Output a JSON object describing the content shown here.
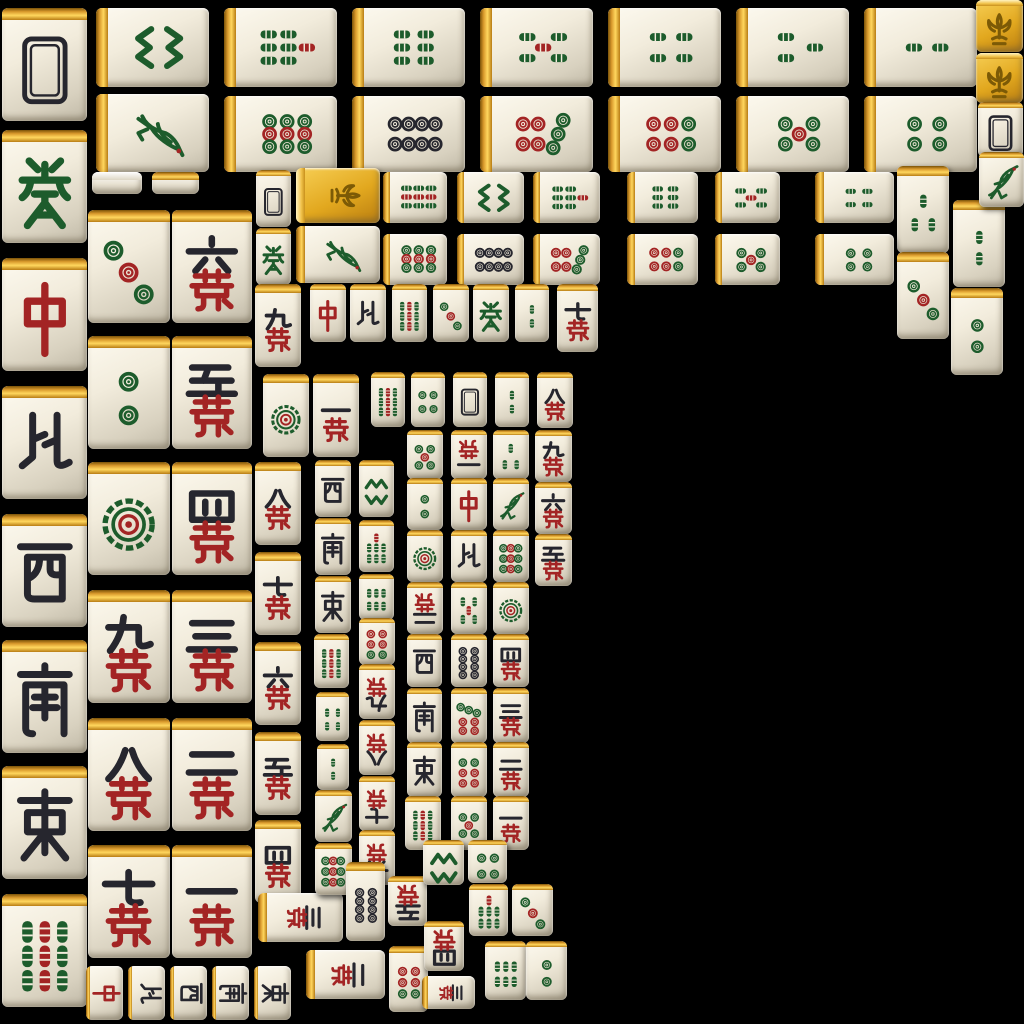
{
  "scene": {
    "title": "Mahjong tile sprite atlas",
    "background_color": "#000000",
    "canvas": {
      "width": 1024,
      "height": 1024
    }
  },
  "palette": {
    "tile_face": "#f2ecdc",
    "tile_shade": "#bfb8a6",
    "gold_edge": "#e2a81f",
    "glyph_black": "#26262e",
    "glyph_red": "#a32424",
    "glyph_green": "#1d5c2c",
    "flower_gold": "#e2a81f",
    "flower_glyph": "#7c5a06"
  },
  "legend": {
    "suits": {
      "bamboo": "Bamboo (sticks, rank 1 is the sparrow bird)",
      "circle": "Circles (dots)",
      "char": "Characters — numeral over red wan (10k)",
      "wind": "Winds: E=East(dong) S=South(nan) W=West(xi) N=North(bei)",
      "dragon": "Dragons: red=zhong, green=fa",
      "back": "Blank tile back / White Dragon frame",
      "flower": "Gold flower (fleur-de-lis) tile",
      "side": "Tile side sprite strip"
    },
    "rotations": {
      "0": "upright",
      "90": "rotated sideways",
      "180": "inverted (opponent view)"
    }
  },
  "tiles": [
    [
      2,
      8,
      85,
      113,
      0,
      "back",
      ""
    ],
    [
      2,
      130,
      85,
      113,
      0,
      "dragon",
      "green"
    ],
    [
      2,
      258,
      85,
      113,
      0,
      "dragon",
      "red"
    ],
    [
      2,
      386,
      85,
      113,
      0,
      "wind",
      "N"
    ],
    [
      2,
      514,
      85,
      113,
      0,
      "wind",
      "W"
    ],
    [
      2,
      640,
      85,
      113,
      0,
      "wind",
      "S"
    ],
    [
      2,
      766,
      85,
      113,
      0,
      "wind",
      "E"
    ],
    [
      2,
      894,
      85,
      113,
      0,
      "bamboo",
      9
    ],
    [
      88,
      210,
      82,
      113,
      0,
      "circle",
      3
    ],
    [
      88,
      336,
      82,
      113,
      0,
      "circle",
      2
    ],
    [
      88,
      462,
      82,
      113,
      0,
      "circle",
      1
    ],
    [
      88,
      590,
      82,
      113,
      0,
      "char",
      9
    ],
    [
      88,
      718,
      82,
      113,
      0,
      "char",
      8
    ],
    [
      88,
      845,
      82,
      113,
      0,
      "char",
      7
    ],
    [
      172,
      210,
      80,
      113,
      0,
      "char",
      6
    ],
    [
      172,
      336,
      80,
      113,
      0,
      "char",
      5
    ],
    [
      172,
      462,
      80,
      113,
      0,
      "char",
      4
    ],
    [
      172,
      590,
      80,
      113,
      0,
      "char",
      3
    ],
    [
      172,
      718,
      80,
      113,
      0,
      "char",
      2
    ],
    [
      172,
      845,
      80,
      113,
      0,
      "char",
      1
    ],
    [
      96,
      8,
      113,
      79,
      90,
      "bamboo",
      8
    ],
    [
      224,
      8,
      113,
      79,
      90,
      "bamboo",
      7
    ],
    [
      352,
      8,
      113,
      79,
      90,
      "bamboo",
      6
    ],
    [
      480,
      8,
      113,
      79,
      90,
      "bamboo",
      5
    ],
    [
      608,
      8,
      113,
      79,
      90,
      "bamboo",
      4
    ],
    [
      736,
      8,
      113,
      79,
      90,
      "bamboo",
      3
    ],
    [
      864,
      8,
      113,
      79,
      90,
      "bamboo",
      2
    ],
    [
      96,
      94,
      113,
      78,
      90,
      "bamboo",
      1
    ],
    [
      224,
      96,
      113,
      76,
      90,
      "circle",
      9
    ],
    [
      352,
      96,
      113,
      76,
      90,
      "circle",
      8
    ],
    [
      480,
      96,
      113,
      76,
      90,
      "circle",
      7
    ],
    [
      608,
      96,
      113,
      76,
      90,
      "circle",
      6
    ],
    [
      736,
      96,
      113,
      76,
      90,
      "circle",
      5
    ],
    [
      864,
      96,
      113,
      76,
      90,
      "circle",
      4
    ],
    [
      92,
      172,
      50,
      22,
      0,
      "side",
      ""
    ],
    [
      152,
      172,
      47,
      22,
      0,
      "side",
      "gold"
    ],
    [
      256,
      170,
      35,
      57,
      0,
      "back",
      ""
    ],
    [
      296,
      168,
      84,
      55,
      90,
      "flower",
      ""
    ],
    [
      383,
      172,
      64,
      51,
      90,
      "bamboo",
      9
    ],
    [
      457,
      172,
      67,
      51,
      90,
      "bamboo",
      8
    ],
    [
      533,
      172,
      67,
      51,
      90,
      "bamboo",
      7
    ],
    [
      627,
      172,
      71,
      51,
      90,
      "bamboo",
      6
    ],
    [
      715,
      172,
      65,
      51,
      90,
      "bamboo",
      5
    ],
    [
      815,
      172,
      79,
      51,
      90,
      "bamboo",
      4
    ],
    [
      897,
      166,
      52,
      87,
      0,
      "bamboo",
      3
    ],
    [
      256,
      228,
      35,
      57,
      0,
      "dragon",
      "green"
    ],
    [
      296,
      226,
      84,
      57,
      90,
      "bamboo",
      1
    ],
    [
      383,
      234,
      64,
      51,
      90,
      "circle",
      9
    ],
    [
      457,
      234,
      67,
      51,
      90,
      "circle",
      8
    ],
    [
      533,
      234,
      67,
      51,
      90,
      "circle",
      7
    ],
    [
      627,
      234,
      71,
      51,
      90,
      "circle",
      6
    ],
    [
      715,
      234,
      65,
      51,
      90,
      "circle",
      5
    ],
    [
      815,
      234,
      79,
      51,
      90,
      "circle",
      4
    ],
    [
      897,
      252,
      52,
      87,
      0,
      "circle",
      3
    ],
    [
      953,
      200,
      52,
      87,
      0,
      "bamboo",
      2
    ],
    [
      951,
      288,
      52,
      87,
      0,
      "circle",
      2
    ],
    [
      976,
      0,
      47,
      52,
      0,
      "flower",
      ""
    ],
    [
      976,
      53,
      47,
      50,
      0,
      "flower",
      ""
    ],
    [
      978,
      102,
      45,
      55,
      0,
      "back",
      ""
    ],
    [
      979,
      152,
      45,
      55,
      0,
      "bamboo",
      1
    ],
    [
      255,
      284,
      46,
      83,
      0,
      "char",
      9
    ],
    [
      310,
      284,
      36,
      58,
      0,
      "dragon",
      "red"
    ],
    [
      350,
      284,
      36,
      58,
      0,
      "wind",
      "N"
    ],
    [
      392,
      284,
      35,
      58,
      0,
      "bamboo",
      9
    ],
    [
      433,
      284,
      36,
      58,
      0,
      "circle",
      3
    ],
    [
      473,
      284,
      36,
      58,
      0,
      "dragon",
      "green"
    ],
    [
      515,
      284,
      34,
      58,
      0,
      "bamboo",
      2
    ],
    [
      557,
      284,
      41,
      68,
      0,
      "char",
      7
    ],
    [
      263,
      374,
      46,
      83,
      0,
      "circle",
      1
    ],
    [
      313,
      374,
      46,
      83,
      0,
      "char",
      1
    ],
    [
      255,
      462,
      46,
      83,
      0,
      "char",
      8
    ],
    [
      255,
      552,
      46,
      83,
      0,
      "char",
      7
    ],
    [
      255,
      642,
      46,
      83,
      0,
      "char",
      6
    ],
    [
      255,
      732,
      46,
      83,
      0,
      "char",
      5
    ],
    [
      255,
      820,
      46,
      83,
      0,
      "char",
      4
    ],
    [
      258,
      893,
      85,
      49,
      90,
      "char",
      3
    ],
    [
      306,
      950,
      79,
      49,
      90,
      "char",
      2
    ],
    [
      315,
      460,
      36,
      57,
      0,
      "wind",
      "W"
    ],
    [
      315,
      518,
      36,
      57,
      0,
      "wind",
      "S"
    ],
    [
      315,
      576,
      36,
      57,
      0,
      "wind",
      "E"
    ],
    [
      314,
      634,
      35,
      54,
      0,
      "bamboo",
      9
    ],
    [
      316,
      692,
      33,
      49,
      0,
      "bamboo",
      4
    ],
    [
      317,
      744,
      32,
      46,
      0,
      "bamboo",
      2
    ],
    [
      315,
      790,
      37,
      52,
      0,
      "bamboo",
      1
    ],
    [
      315,
      843,
      37,
      52,
      0,
      "circle",
      9
    ],
    [
      359,
      460,
      35,
      57,
      0,
      "bamboo",
      8
    ],
    [
      359,
      520,
      35,
      52,
      0,
      "bamboo",
      7
    ],
    [
      359,
      574,
      35,
      46,
      0,
      "bamboo",
      6
    ],
    [
      359,
      618,
      36,
      47,
      180,
      "circle",
      6
    ],
    [
      359,
      664,
      36,
      55,
      180,
      "char",
      9
    ],
    [
      359,
      720,
      36,
      55,
      180,
      "char",
      8
    ],
    [
      359,
      776,
      36,
      55,
      180,
      "char",
      7
    ],
    [
      359,
      830,
      36,
      55,
      180,
      "char",
      6
    ],
    [
      371,
      372,
      34,
      55,
      0,
      "bamboo",
      9
    ],
    [
      411,
      372,
      34,
      55,
      0,
      "circle",
      4
    ],
    [
      453,
      372,
      34,
      55,
      0,
      "back",
      ""
    ],
    [
      495,
      372,
      34,
      55,
      0,
      "bamboo",
      2
    ],
    [
      537,
      372,
      36,
      56,
      0,
      "char",
      8
    ],
    [
      407,
      430,
      36,
      49,
      0,
      "circle",
      5
    ],
    [
      451,
      430,
      36,
      49,
      180,
      "char",
      1
    ],
    [
      493,
      430,
      36,
      49,
      0,
      "bamboo",
      3
    ],
    [
      535,
      430,
      37,
      52,
      0,
      "char",
      9
    ],
    [
      407,
      478,
      36,
      52,
      0,
      "circle",
      2
    ],
    [
      451,
      478,
      36,
      52,
      0,
      "dragon",
      "red"
    ],
    [
      493,
      478,
      36,
      52,
      0,
      "bamboo",
      1
    ],
    [
      535,
      482,
      37,
      52,
      0,
      "char",
      6
    ],
    [
      407,
      530,
      36,
      52,
      0,
      "circle",
      1
    ],
    [
      451,
      530,
      36,
      52,
      0,
      "wind",
      "N"
    ],
    [
      493,
      530,
      36,
      52,
      0,
      "circle",
      9
    ],
    [
      535,
      534,
      37,
      52,
      0,
      "char",
      5
    ],
    [
      407,
      582,
      36,
      52,
      180,
      "char",
      2
    ],
    [
      451,
      582,
      36,
      52,
      0,
      "bamboo",
      5
    ],
    [
      493,
      582,
      36,
      52,
      0,
      "circle",
      1
    ],
    [
      407,
      634,
      35,
      53,
      0,
      "wind",
      "W"
    ],
    [
      451,
      634,
      36,
      53,
      0,
      "circle",
      8
    ],
    [
      493,
      634,
      36,
      53,
      0,
      "char",
      4
    ],
    [
      407,
      688,
      35,
      55,
      0,
      "wind",
      "S"
    ],
    [
      451,
      688,
      36,
      55,
      0,
      "circle",
      7
    ],
    [
      493,
      688,
      36,
      55,
      0,
      "char",
      3
    ],
    [
      407,
      742,
      35,
      55,
      0,
      "wind",
      "E"
    ],
    [
      451,
      742,
      36,
      55,
      0,
      "circle",
      6
    ],
    [
      493,
      742,
      36,
      55,
      0,
      "char",
      2
    ],
    [
      405,
      796,
      36,
      54,
      0,
      "bamboo",
      9
    ],
    [
      451,
      796,
      36,
      54,
      0,
      "circle",
      5
    ],
    [
      493,
      796,
      36,
      54,
      0,
      "char",
      1
    ],
    [
      346,
      862,
      39,
      79,
      0,
      "circle",
      8
    ],
    [
      388,
      876,
      39,
      50,
      180,
      "char",
      5
    ],
    [
      389,
      946,
      39,
      66,
      180,
      "circle",
      6
    ],
    [
      424,
      921,
      40,
      50,
      180,
      "char",
      4
    ],
    [
      423,
      840,
      41,
      45,
      0,
      "bamboo",
      8
    ],
    [
      468,
      840,
      39,
      43,
      0,
      "circle",
      4
    ],
    [
      469,
      884,
      39,
      52,
      0,
      "bamboo",
      7
    ],
    [
      512,
      884,
      41,
      52,
      0,
      "circle",
      3
    ],
    [
      422,
      976,
      53,
      33,
      90,
      "char",
      3
    ],
    [
      485,
      941,
      41,
      59,
      0,
      "bamboo",
      6
    ],
    [
      526,
      941,
      41,
      59,
      0,
      "circle",
      2
    ],
    [
      86,
      966,
      37,
      54,
      90,
      "dragon",
      "red"
    ],
    [
      128,
      966,
      37,
      54,
      90,
      "wind",
      "N"
    ],
    [
      170,
      966,
      37,
      54,
      90,
      "wind",
      "W"
    ],
    [
      212,
      966,
      37,
      54,
      90,
      "wind",
      "S"
    ],
    [
      254,
      966,
      37,
      54,
      90,
      "wind",
      "E"
    ]
  ]
}
